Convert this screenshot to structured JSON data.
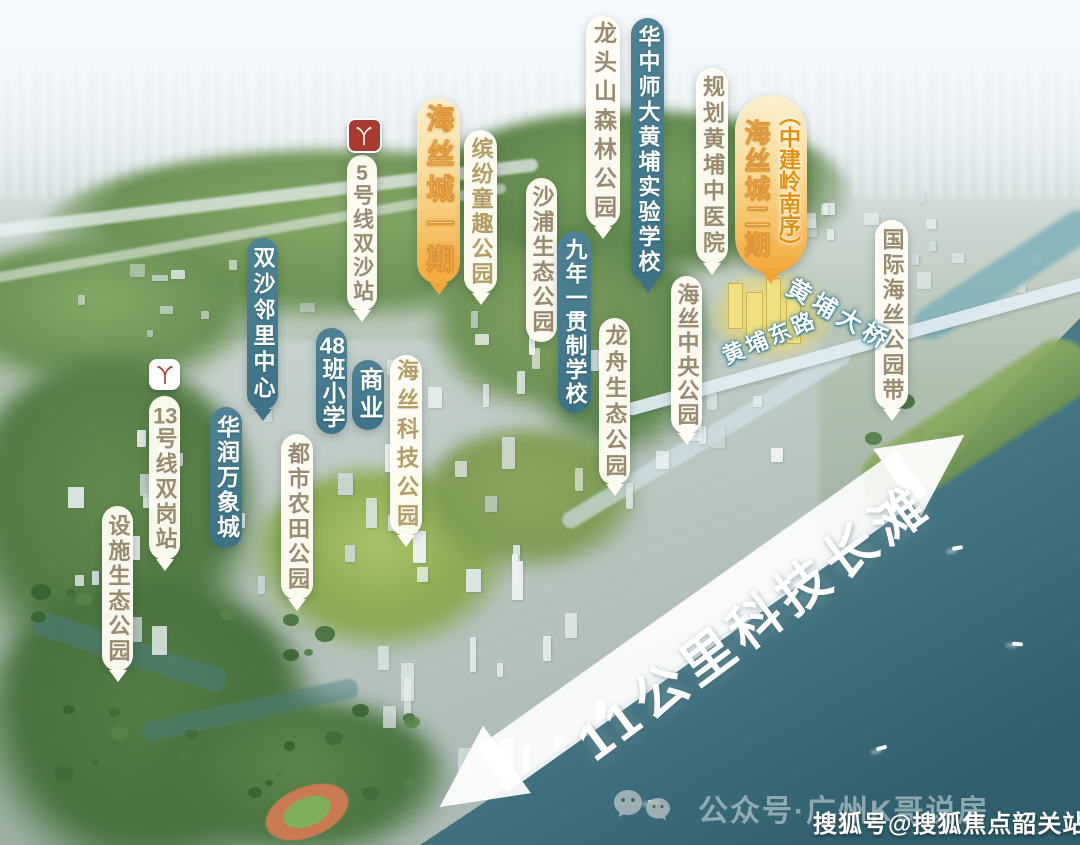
{
  "canvas": {
    "width": 1080,
    "height": 845
  },
  "colors": {
    "teal_pill": "#45798b",
    "white_pill": "#fffdf4",
    "white_pill_text": "#998b71",
    "white_pill_text_gold": "#b39c66",
    "gold_pill_top": "#fbf0d0",
    "gold_pill_bottom": "#f3a83a",
    "gold_stroke": "#d8861a",
    "metro_red": "#a93a30",
    "water_deep": "#2f5f6d",
    "arrow_white": "#ffffff"
  },
  "callouts": [
    {
      "id": "line5-shuangsha-station",
      "label": "5号线双沙站",
      "style": "white",
      "icon": "metro-red",
      "x": 347,
      "y": 155,
      "w": 30,
      "h": 156,
      "font": 21,
      "ls": 3,
      "tail": true
    },
    {
      "id": "shuangsha-neighborhood-center",
      "label": "双沙邻里中心",
      "style": "teal",
      "x": 247,
      "y": 238,
      "w": 31,
      "h": 172,
      "font": 22,
      "ls": 4,
      "tail": true
    },
    {
      "id": "haisi-city-phase1",
      "label": "海丝城一期",
      "style": "gold",
      "x": 417,
      "y": 98,
      "w": 43,
      "h": 186,
      "font": 28,
      "ls": 7,
      "tail": true
    },
    {
      "id": "binfen-childhood-fun-park",
      "label": "缤纷童趣公园",
      "style": "white",
      "x": 464,
      "y": 130,
      "w": 33,
      "h": 164,
      "font": 22,
      "ls": 3,
      "tail": true,
      "text_color": "#b39c66"
    },
    {
      "id": "shapu-eco-park",
      "label": "沙浦生态公园",
      "style": "white",
      "x": 526,
      "y": 178,
      "w": 31,
      "h": 164,
      "font": 22,
      "ls": 3,
      "tail": false
    },
    {
      "id": "nine-year-school",
      "label": "九年一贯制学校",
      "style": "teal",
      "x": 558,
      "y": 231,
      "w": 33,
      "h": 182,
      "font": 22,
      "ls": 2,
      "tail": false
    },
    {
      "id": "longtoushan-forest-park",
      "label": "龙头山森林公园",
      "style": "white",
      "x": 586,
      "y": 16,
      "w": 34,
      "h": 212,
      "font": 23,
      "ls": 6,
      "tail": true
    },
    {
      "id": "huazhong-normal-univ-huangpu-school",
      "label": "华中师大黄埔实验学校",
      "style": "teal",
      "x": 631,
      "y": 18,
      "w": 33,
      "h": 264,
      "font": 22,
      "ls": 3,
      "tail": true
    },
    {
      "id": "planned-huangpu-tcm-hospital",
      "label": "规划黄埔中医院",
      "style": "white",
      "x": 696,
      "y": 68,
      "w": 32,
      "h": 196,
      "font": 22,
      "ls": 4,
      "tail": true
    },
    {
      "id": "haisi-city-phase2",
      "style": "gold2",
      "label_left": "海丝城二期",
      "label_right": "（中建岭南序）",
      "x": 735,
      "y": 95,
      "w": 72,
      "h": 178,
      "font_left": 26,
      "font_right": 22,
      "tail": true
    },
    {
      "id": "longzhou-eco-park",
      "label": "龙舟生态公园",
      "style": "white",
      "x": 599,
      "y": 318,
      "w": 31,
      "h": 167,
      "font": 22,
      "ls": 4,
      "tail": true
    },
    {
      "id": "haisi-central-park",
      "label": "海丝中央公园",
      "style": "white",
      "x": 671,
      "y": 276,
      "w": 31,
      "h": 158,
      "font": 22,
      "ls": 2,
      "tail": true
    },
    {
      "id": "international-haisi-park-belt",
      "label": "国际海丝公园带",
      "style": "white",
      "x": 875,
      "y": 220,
      "w": 33,
      "h": 190,
      "font": 22,
      "ls": 3,
      "tail": true
    },
    {
      "id": "line13-shuanggang-station",
      "label": "13号线双岗站",
      "style": "white",
      "icon": "metro-white",
      "x": 149,
      "y": 396,
      "w": 31,
      "h": 164,
      "font": 22,
      "ls": 3,
      "tail": true
    },
    {
      "id": "china-resources-mixc",
      "label": "华润万象城",
      "style": "teal",
      "x": 210,
      "y": 407,
      "w": 32,
      "h": 141,
      "font": 23,
      "ls": 2,
      "tail": false
    },
    {
      "id": "facility-eco-park",
      "label": "设施生态公园",
      "style": "white",
      "x": 102,
      "y": 506,
      "w": 31,
      "h": 165,
      "font": 22,
      "ls": 3,
      "tail": true
    },
    {
      "id": "urban-farmland-park",
      "label": "都市农田公园",
      "style": "white",
      "x": 281,
      "y": 434,
      "w": 32,
      "h": 166,
      "font": 22,
      "ls": 3,
      "tail": true
    },
    {
      "id": "school-48-classes",
      "label": "48班小学",
      "style": "teal",
      "x": 316,
      "y": 328,
      "w": 31,
      "h": 106,
      "font": 23,
      "ls": 1,
      "tail": false
    },
    {
      "id": "commercial",
      "label": "商业",
      "style": "teal",
      "x": 352,
      "y": 360,
      "w": 32,
      "h": 70,
      "font": 24,
      "ls": 4,
      "tail": false
    },
    {
      "id": "haisi-tech-park",
      "label": "海丝科技公园",
      "style": "white",
      "x": 390,
      "y": 355,
      "w": 32,
      "h": 181,
      "font": 22,
      "ls": 7,
      "tail": true,
      "text_color": "#b39c66"
    }
  ],
  "road_labels": [
    {
      "id": "huangpu-bridge",
      "label": "黄埔大桥",
      "x": 790,
      "y": 266,
      "rotate": 30,
      "font": 24,
      "ls": 5
    },
    {
      "id": "huangpu-east-road",
      "label": "黄埔东路",
      "x": 723,
      "y": 340,
      "rotate": -23,
      "font": 22,
      "ls": 3
    }
  ],
  "shore_arrow": {
    "label": "11公里科技长滩",
    "line": {
      "x1": 492,
      "y1": 770,
      "x2": 912,
      "y2": 472,
      "width": 54
    }
  },
  "highlight": {
    "name": "haisi-city-phase2-highlighted-buildings"
  },
  "watermarks": {
    "wechat_account": "公众号·广州K哥说房",
    "sohu_account": "搜狐号@搜狐焦点韶关站"
  },
  "icons": {
    "metro": "guangzhou-metro-logo",
    "wechat": "wechat-chat-bubbles"
  }
}
